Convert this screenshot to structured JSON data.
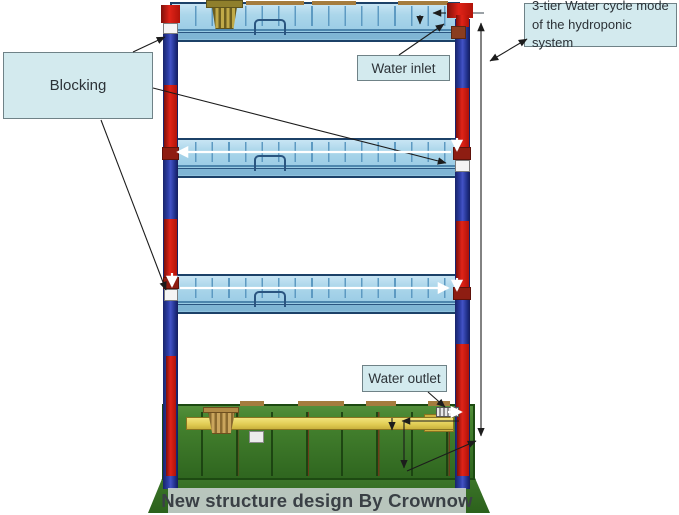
{
  "caption": "New structure design By Crownow",
  "callouts": {
    "blocking": "Blocking",
    "water_inlet": "Water inlet",
    "water_outlet": "Water outlet",
    "cycle_mode_line1": "3-tier Water cycle mode",
    "cycle_mode_line2": "of the hydroponic system"
  },
  "diagram": {
    "subject": "3-tier hydroponic rack water-cycle diagram",
    "tier_count": 3,
    "components": [
      "grow-tray",
      "frame-post",
      "water-pipe",
      "blocking-plug",
      "net-pot",
      "water-tank",
      "drain-bar",
      "water-outlet-fitting",
      "water-inlet-pipe"
    ],
    "colors": {
      "frame_blue": "#2c3b9e",
      "pipe_red": "#d32015",
      "tray_blue": "#a8d4e9",
      "tank_green": "#3c7b2b",
      "bar_yellow": "#e2cf5e",
      "callout_fill": "#d3eaee",
      "caption_band": "#d0d6d8"
    }
  }
}
